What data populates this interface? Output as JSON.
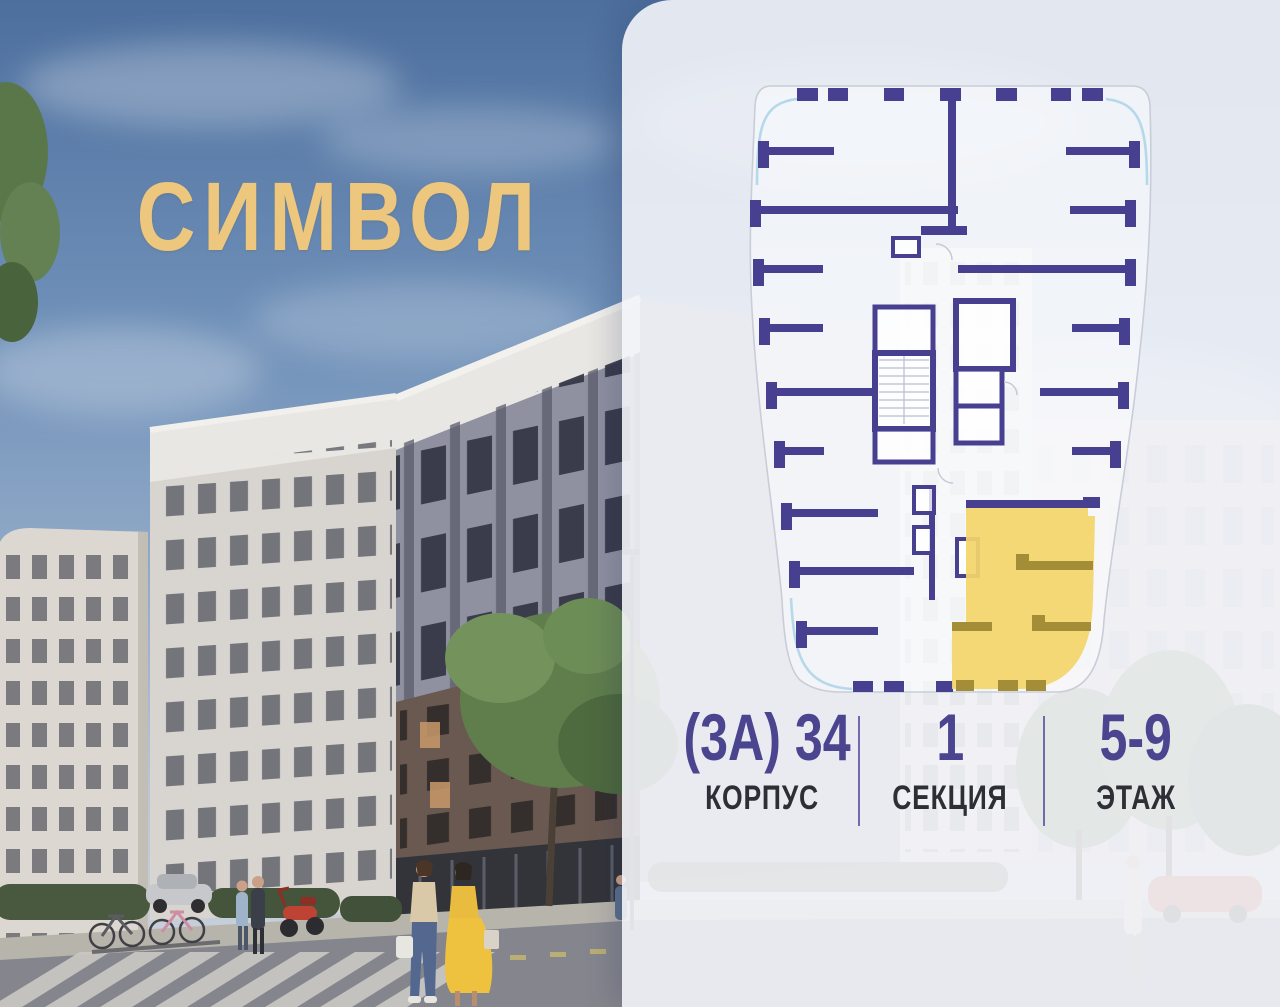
{
  "logo": {
    "text": "СИМВОЛ",
    "color": "#ecc77d"
  },
  "info": {
    "building": {
      "value": "(3А) 34",
      "label": "КОРПУС"
    },
    "section": {
      "value": "1",
      "label": "СЕКЦИЯ"
    },
    "floor": {
      "value": "5-9",
      "label": "ЭТАЖ"
    }
  },
  "floor_plan": {
    "wall_color": "#474090",
    "outline_color": "#c9cdd8",
    "glazing_color": "#b5d9ea",
    "selected_apartment": {
      "highlight_color": "#f3d56b",
      "inner_wall_color": "#a38e37"
    }
  },
  "accent_color": "#4b4590",
  "panel_background": "#f3f4f8"
}
